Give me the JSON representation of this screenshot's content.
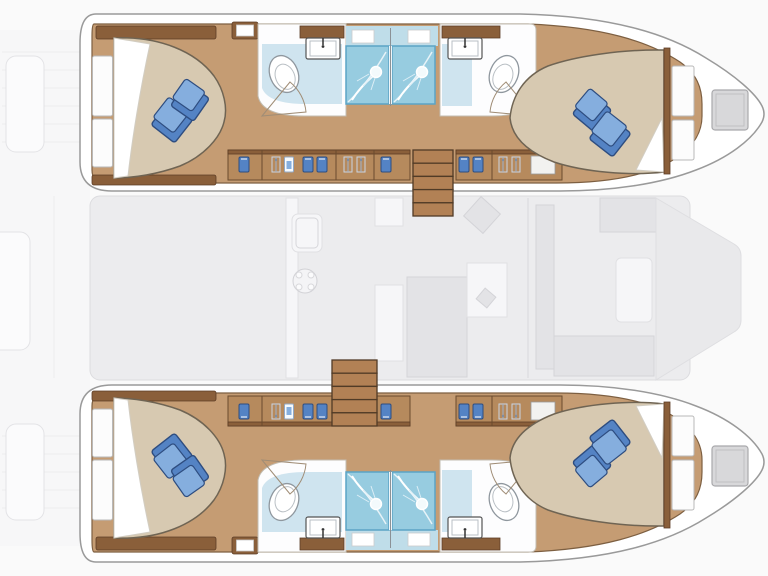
{
  "diagram": {
    "type": "floor_plan",
    "subject": "catamaran-interior-deck-plan",
    "hulls": [
      {
        "name": "port hull",
        "rooms": [
          "aft cabin",
          "aft bathroom",
          "shower stall",
          "shower stall",
          "forward bathroom",
          "forward cabin"
        ],
        "beds": 2,
        "pillows_per_bed": 2,
        "wardrobes": 2,
        "deck_hatches": 1
      },
      {
        "name": "starboard hull",
        "rooms": [
          "aft cabin",
          "aft bathroom",
          "shower stall",
          "shower stall",
          "forward bathroom",
          "forward cabin"
        ],
        "beds": 2,
        "pillows_per_bed": 2,
        "wardrobes": 2,
        "deck_hatches": 1
      }
    ],
    "saloon": {
      "features": [
        "galley sink",
        "stove burner",
        "galley island",
        "table",
        "seating",
        "companionway landings"
      ]
    },
    "decks": [
      "aft deck",
      "foredeck"
    ]
  },
  "colors": {
    "bg": "#fafafa",
    "hull-stroke": "#9a9a9a",
    "wood": "#c59c73",
    "wood-edge": "#7d5f41",
    "cabinet": "#b68a5d",
    "cabinet-dark": "#8a5f3a",
    "cabinet-edge": "#6b4b2e",
    "stair": "#b28155",
    "stair-edge": "#513b26",
    "bed": "#d7c9b1",
    "bed-edge": "#6f6453",
    "pillow-light": "#85aede",
    "pillow-mid": "#5483c4",
    "pillow-dark": "#2e4d80",
    "bath-floor": "#fdfdfe",
    "bath-blue": "#cfe4ef",
    "shower": "#97cce0",
    "shower-deep": "#5ba3c6",
    "fixture": "#8f979e",
    "door": "#a08d76",
    "saloon-fill": "#ececee",
    "saloon-item": "#f6f6f8",
    "deck-fill": "#f7f7f8",
    "deck-line": "#ececee",
    "hatch-fill": "#d8d8da",
    "hatch-stroke": "#a9a9ac"
  },
  "wardrobe_icons": [
    {
      "x": 244,
      "type": "shirt-blue"
    },
    {
      "x": 276,
      "type": "hanger"
    },
    {
      "x": 289,
      "type": "shirt-white"
    },
    {
      "x": 308,
      "type": "shirt-blue"
    },
    {
      "x": 322,
      "type": "shirt-blue"
    },
    {
      "x": 348,
      "type": "hanger"
    },
    {
      "x": 361,
      "type": "hanger"
    },
    {
      "x": 386,
      "type": "shirt-blue"
    },
    {
      "x": 464,
      "type": "shirt-blue"
    },
    {
      "x": 478,
      "type": "shirt-blue"
    },
    {
      "x": 503,
      "type": "hanger"
    },
    {
      "x": 516,
      "type": "hanger"
    }
  ],
  "staircases": [
    {
      "name": "port",
      "x": 413,
      "y": 150,
      "width": 40,
      "steps": 5,
      "step_h": 13.2
    },
    {
      "name": "starboard",
      "x": 332,
      "y": 360,
      "width": 45,
      "steps": 5,
      "step_h": 13.2
    }
  ]
}
